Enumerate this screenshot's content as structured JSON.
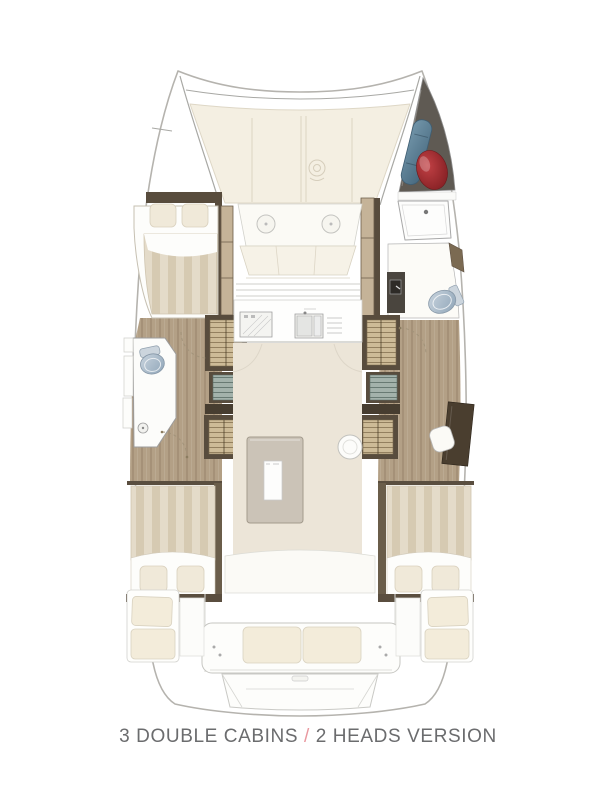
{
  "caption": {
    "part1": "3 DOUBLE CABINS",
    "slash": " / ",
    "part2": "2 HEADS VERSION"
  },
  "colors": {
    "outline": "#b5b3ae",
    "line_gray": "#cfcfcb",
    "cream": "#f4efe2",
    "floor": "#ece5d8",
    "cushion": "#f3ecda",
    "wood": "#b3a086",
    "wood_light": "#c5b398",
    "dark_brown": "#584c3d",
    "steps_tan": "#cdbb97",
    "steps_teal": "#a3b2ab",
    "stripe_a": "#e4dbc9",
    "stripe_b": "#d6cab2",
    "pillow": "#f0e9d9",
    "sheet": "#fdfdfb",
    "table_gray": "#cbc3b7",
    "toilet_a": "#c9d4de",
    "toilet_b": "#8fa5b8",
    "fender_a": "#c24145",
    "fender_b": "#7e1c20",
    "bag_a": "#7396aa",
    "bag_b": "#46687e",
    "locker_dark": "#5f5a53",
    "caption_gray": "#6b6c6e",
    "slash_pink": "#e9989f"
  }
}
